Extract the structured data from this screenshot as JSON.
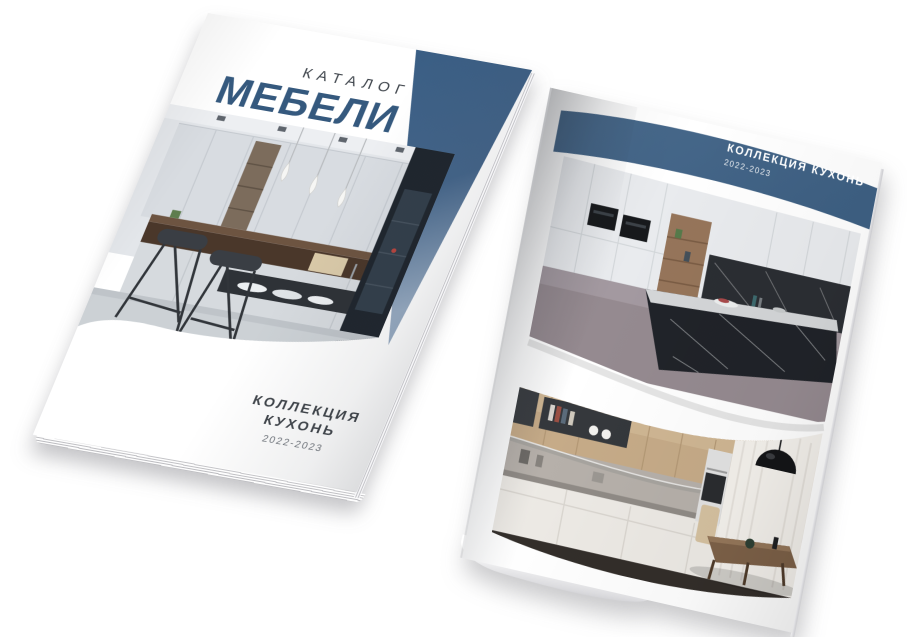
{
  "scene": {
    "background_color": "#FFFFFF"
  },
  "cover_page": {
    "kicker": "КАТАЛОГ",
    "title": "МЕБЕЛИ",
    "collection_line1": "КОЛЛЕКЦИЯ",
    "collection_line2": "КУХОНЬ",
    "years": "2022-2023",
    "accent_color": "#3E6186",
    "kicker_color": "#3E444B",
    "title_color": "#35597E",
    "text_color": "#3F444A"
  },
  "inner_page": {
    "banner_title": "КОЛЛЕКЦИЯ КУХОНЬ",
    "banner_years": "2022-2023",
    "banner_color": "#45678A"
  }
}
